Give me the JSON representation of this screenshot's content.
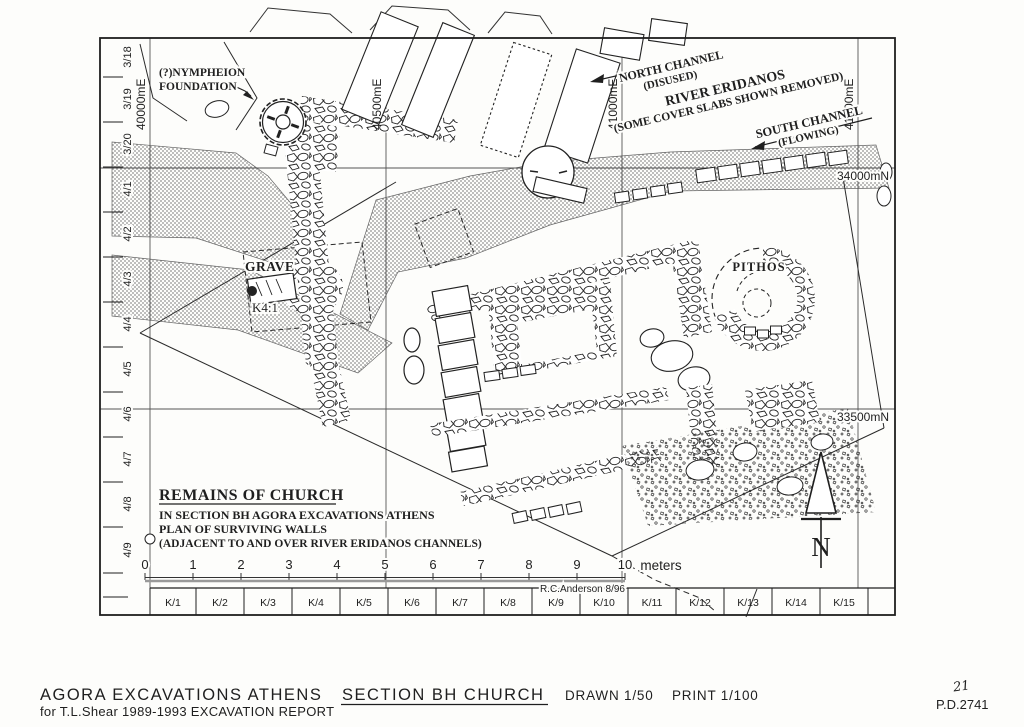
{
  "colors": {
    "paper": "#fdfdfb",
    "ink": "#1f1f1f",
    "halftone_gray": "#8a8a8a",
    "grid_line": "#555555"
  },
  "map": {
    "eastings": [
      "40000mE",
      "40500mE",
      "41000mE",
      "41500mE"
    ],
    "northings": [
      "34000mN",
      "33500mN"
    ],
    "left_ruler": [
      "3/18",
      "3/19",
      "3/20",
      "4/1",
      "4/2",
      "4/3",
      "4/4",
      "4/5",
      "4/6",
      "4/7",
      "4/8",
      "4/9"
    ],
    "bottom_ruler": [
      "K/1",
      "K/2",
      "K/3",
      "K/4",
      "K/5",
      "K/6",
      "K/7",
      "K/8",
      "K/9",
      "K/10",
      "K/11",
      "K/12",
      "K/13",
      "K/14",
      "K/15"
    ],
    "labels": {
      "nympheion_line1": "(?)NYMPHEION",
      "nympheion_line2": "FOUNDATION",
      "north_channel_line1": "NORTH CHANNEL",
      "north_channel_line2": "(DISUSED)",
      "river_line1": "RIVER ERIDANOS",
      "river_line2": "(SOME COVER SLABS SHOWN REMOVED)",
      "south_channel_line1": "SOUTH CHANNEL",
      "south_channel_line2": "(FLOWING)",
      "grave": "GRAVE",
      "grave_number": "K4:1",
      "pithos": "PITHOS"
    },
    "legend": {
      "heading": "REMAINS OF CHURCH",
      "line1": "IN SECTION BH  AGORA EXCAVATIONS ATHENS",
      "line2": "PLAN OF SURVIVING WALLS",
      "line3": "(ADJACENT TO AND OVER RIVER ERIDANOS CHANNELS)"
    },
    "scale_bar": {
      "ticks": [
        "0",
        "1",
        "2",
        "3",
        "4",
        "5",
        "6",
        "7",
        "8",
        "9",
        "10"
      ],
      "unit": "meters",
      "credit": "R.C.Anderson  8/96"
    },
    "north_arrow_letter": "N"
  },
  "caption": {
    "main": "AGORA EXCAVATIONS ATHENS",
    "underlined": "SECTION BH CHURCH",
    "drawn": "DRAWN 1/50",
    "print": "PRINT 1/100",
    "subtitle": "for T.L.Shear 1989-1993 EXCAVATION REPORT"
  },
  "corner": {
    "page_number": "21",
    "drawing_number": "P.D.2741"
  }
}
